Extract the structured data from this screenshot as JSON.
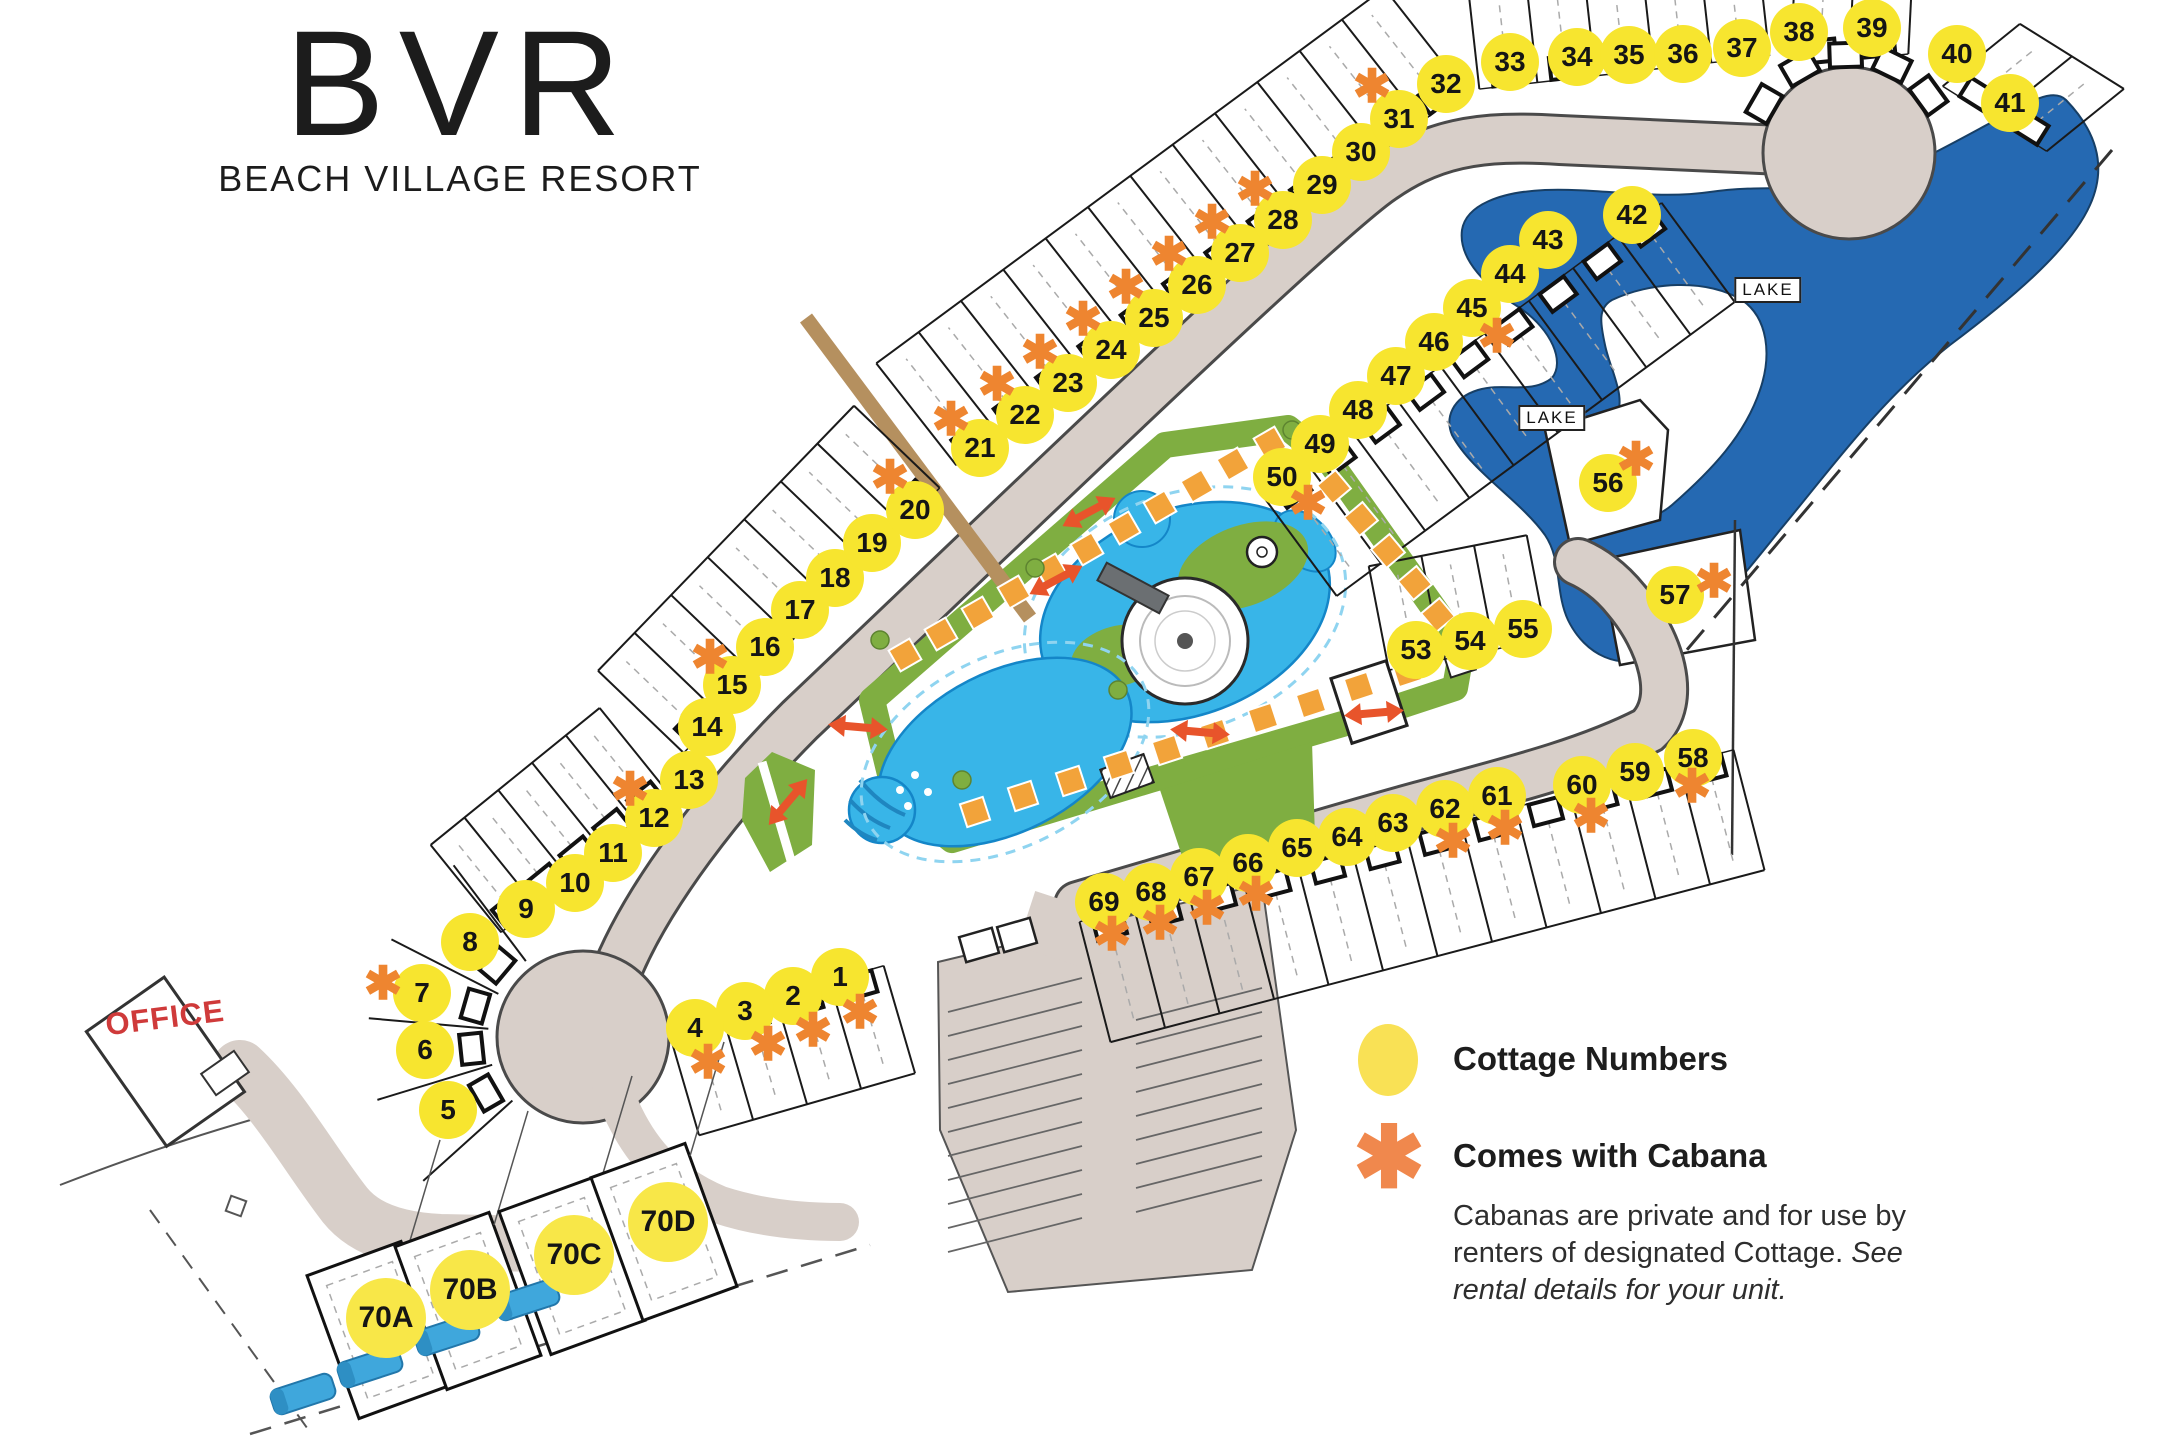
{
  "logo": {
    "abbr": "BVR",
    "name": "BEACH VILLAGE RESORT"
  },
  "office_label": "OFFICE",
  "lake_labels": [
    {
      "text": "LAKE",
      "x": 1768,
      "y": 290
    },
    {
      "text": "LAKE",
      "x": 1552,
      "y": 418
    }
  ],
  "legend": {
    "cottage_label": "Cottage Numbers",
    "cabana_label": "Comes with Cabana",
    "cabana_symbol": "✱",
    "note_normal": "Cabanas are private and for use by renters of designated Cottage. ",
    "note_italic": "See rental details for your unit."
  },
  "colors": {
    "circle_yellow": "#f7e52f",
    "asterisk_orange": "#ee8530",
    "road": "#d8cfc9",
    "lake": "#2569b2",
    "green": "#7fae41",
    "pool": "#38b5e8",
    "office_red": "#cf3a3a"
  },
  "map": {
    "cottages": [
      {
        "n": "1",
        "x": 840,
        "y": 977,
        "ax": 860,
        "ay": 1012
      },
      {
        "n": "2",
        "x": 793,
        "y": 996,
        "ax": 813,
        "ay": 1030
      },
      {
        "n": "3",
        "x": 745,
        "y": 1011,
        "ax": 768,
        "ay": 1044
      },
      {
        "n": "4",
        "x": 695,
        "y": 1028,
        "ax": 708,
        "ay": 1062
      },
      {
        "n": "5",
        "x": 448,
        "y": 1110
      },
      {
        "n": "6",
        "x": 425,
        "y": 1050
      },
      {
        "n": "7",
        "x": 422,
        "y": 993,
        "ax": 383,
        "ay": 983
      },
      {
        "n": "8",
        "x": 470,
        "y": 942
      },
      {
        "n": "9",
        "x": 526,
        "y": 909
      },
      {
        "n": "10",
        "x": 575,
        "y": 883
      },
      {
        "n": "11",
        "x": 613,
        "y": 853
      },
      {
        "n": "12",
        "x": 654,
        "y": 818,
        "ax": 630,
        "ay": 789
      },
      {
        "n": "13",
        "x": 689,
        "y": 780
      },
      {
        "n": "14",
        "x": 707,
        "y": 727
      },
      {
        "n": "15",
        "x": 732,
        "y": 685,
        "ax": 710,
        "ay": 657
      },
      {
        "n": "16",
        "x": 765,
        "y": 647
      },
      {
        "n": "17",
        "x": 800,
        "y": 610
      },
      {
        "n": "18",
        "x": 835,
        "y": 578
      },
      {
        "n": "19",
        "x": 872,
        "y": 543
      },
      {
        "n": "20",
        "x": 915,
        "y": 510,
        "ax": 890,
        "ay": 477
      },
      {
        "n": "21",
        "x": 980,
        "y": 448,
        "ax": 951,
        "ay": 419
      },
      {
        "n": "22",
        "x": 1025,
        "y": 415,
        "ax": 997,
        "ay": 384
      },
      {
        "n": "23",
        "x": 1068,
        "y": 383,
        "ax": 1040,
        "ay": 352
      },
      {
        "n": "24",
        "x": 1111,
        "y": 350,
        "ax": 1083,
        "ay": 319
      },
      {
        "n": "25",
        "x": 1154,
        "y": 318,
        "ax": 1126,
        "ay": 287
      },
      {
        "n": "26",
        "x": 1197,
        "y": 285,
        "ax": 1169,
        "ay": 254
      },
      {
        "n": "27",
        "x": 1240,
        "y": 253,
        "ax": 1212,
        "ay": 222
      },
      {
        "n": "28",
        "x": 1283,
        "y": 220,
        "ax": 1255,
        "ay": 189
      },
      {
        "n": "29",
        "x": 1322,
        "y": 185
      },
      {
        "n": "30",
        "x": 1361,
        "y": 152
      },
      {
        "n": "31",
        "x": 1399,
        "y": 119,
        "ax": 1372,
        "ay": 86
      },
      {
        "n": "32",
        "x": 1446,
        "y": 84
      },
      {
        "n": "33",
        "x": 1510,
        "y": 62
      },
      {
        "n": "34",
        "x": 1577,
        "y": 57
      },
      {
        "n": "35",
        "x": 1629,
        "y": 55
      },
      {
        "n": "36",
        "x": 1683,
        "y": 54
      },
      {
        "n": "37",
        "x": 1742,
        "y": 48
      },
      {
        "n": "38",
        "x": 1799,
        "y": 32
      },
      {
        "n": "39",
        "x": 1872,
        "y": 28
      },
      {
        "n": "40",
        "x": 1957,
        "y": 54
      },
      {
        "n": "41",
        "x": 2010,
        "y": 103
      },
      {
        "n": "42",
        "x": 1632,
        "y": 215
      },
      {
        "n": "43",
        "x": 1548,
        "y": 240
      },
      {
        "n": "44",
        "x": 1510,
        "y": 274
      },
      {
        "n": "45",
        "x": 1472,
        "y": 308,
        "ax": 1497,
        "ay": 336
      },
      {
        "n": "46",
        "x": 1434,
        "y": 342
      },
      {
        "n": "47",
        "x": 1396,
        "y": 376
      },
      {
        "n": "48",
        "x": 1358,
        "y": 410
      },
      {
        "n": "49",
        "x": 1320,
        "y": 444
      },
      {
        "n": "50",
        "x": 1282,
        "y": 477,
        "ax": 1308,
        "ay": 503
      },
      {
        "n": "53",
        "x": 1416,
        "y": 650
      },
      {
        "n": "54",
        "x": 1470,
        "y": 641
      },
      {
        "n": "55",
        "x": 1523,
        "y": 629
      },
      {
        "n": "56",
        "x": 1608,
        "y": 483,
        "ax": 1636,
        "ay": 459
      },
      {
        "n": "57",
        "x": 1675,
        "y": 595,
        "ax": 1714,
        "ay": 581
      },
      {
        "n": "58",
        "x": 1693,
        "y": 758,
        "ax": 1692,
        "ay": 786
      },
      {
        "n": "59",
        "x": 1635,
        "y": 772
      },
      {
        "n": "60",
        "x": 1582,
        "y": 785,
        "ax": 1591,
        "ay": 816
      },
      {
        "n": "61",
        "x": 1497,
        "y": 796,
        "ax": 1505,
        "ay": 828
      },
      {
        "n": "62",
        "x": 1445,
        "y": 809,
        "ax": 1453,
        "ay": 841
      },
      {
        "n": "63",
        "x": 1393,
        "y": 823
      },
      {
        "n": "64",
        "x": 1347,
        "y": 837
      },
      {
        "n": "65",
        "x": 1297,
        "y": 848
      },
      {
        "n": "66",
        "x": 1248,
        "y": 863,
        "ax": 1256,
        "ay": 894
      },
      {
        "n": "67",
        "x": 1199,
        "y": 877,
        "ax": 1207,
        "ay": 908
      },
      {
        "n": "68",
        "x": 1151,
        "y": 892,
        "ax": 1160,
        "ay": 923
      },
      {
        "n": "69",
        "x": 1104,
        "y": 902,
        "ax": 1112,
        "ay": 934
      },
      {
        "n": "70A",
        "x": 386,
        "y": 1318,
        "big": true
      },
      {
        "n": "70B",
        "x": 470,
        "y": 1290,
        "big": true
      },
      {
        "n": "70C",
        "x": 574,
        "y": 1255,
        "big": true
      },
      {
        "n": "70D",
        "x": 668,
        "y": 1222,
        "big": true
      }
    ],
    "lot_rows": [
      {
        "x1": 960,
        "y1": 470,
        "x2": 1468,
        "y2": 95,
        "c": 12,
        "nx": -0.62,
        "ny": -0.79,
        "d": 135
      },
      {
        "x1": 1480,
        "y1": 95,
        "x2": 1770,
        "y2": 62,
        "c": 5,
        "nx": -0.11,
        "ny": -0.99,
        "d": 118
      },
      {
        "x1": 1790,
        "y1": 72,
        "x2": 1908,
        "y2": 60,
        "c": 2,
        "nx": 0.05,
        "ny": -1.0,
        "d": 105
      },
      {
        "x1": 1938,
        "y1": 90,
        "x2": 2042,
        "y2": 155,
        "c": 2,
        "nx": 0.78,
        "ny": -0.63,
        "d": 105
      },
      {
        "x1": 1658,
        "y1": 198,
        "x2": 1260,
        "y2": 492,
        "c": 9,
        "nx": 0.59,
        "ny": 0.8,
        "d": 130
      },
      {
        "x1": 1390,
        "y1": 676,
        "x2": 1548,
        "y2": 645,
        "c": 3,
        "nx": -0.19,
        "ny": -0.98,
        "d": 112
      },
      {
        "x1": 1732,
        "y1": 744,
        "x2": 1078,
        "y2": 916,
        "c": 12,
        "nx": 0.25,
        "ny": 0.97,
        "d": 130
      },
      {
        "x1": 882,
        "y1": 960,
        "x2": 666,
        "y2": 1022,
        "c": 4,
        "nx": 0.28,
        "ny": 0.96,
        "d": 118
      },
      {
        "x1": 688,
        "y1": 757,
        "x2": 944,
        "y2": 492,
        "c": 7,
        "nx": -0.72,
        "ny": -0.69,
        "d": 125
      },
      {
        "x1": 505,
        "y1": 937,
        "x2": 674,
        "y2": 800,
        "c": 5,
        "nx": -0.63,
        "ny": -0.78,
        "d": 118
      }
    ],
    "fan": {
      "cx": 583,
      "cy": 1037,
      "r0": 95,
      "r1": 215,
      "angles": [
        138,
        163,
        185,
        207,
        233
      ],
      "fp_angles": [
        150,
        174,
        196,
        220
      ],
      "fp_r": 112
    },
    "culdesac_fp": {
      "cx": 1849,
      "cy": 153,
      "r": 98,
      "angles": [
        210,
        240,
        268,
        296,
        324
      ]
    },
    "big_lots": [
      [
        380,
        1330
      ],
      [
        468,
        1301
      ],
      [
        572,
        1266
      ],
      [
        664,
        1232
      ]
    ],
    "big_lot_rot": -20,
    "rvs": [
      [
        303,
        1394,
        -18
      ],
      [
        370,
        1367,
        -18
      ],
      [
        447,
        1335,
        -18
      ],
      [
        527,
        1300,
        -18
      ]
    ],
    "cabana_squares": [
      [
        905,
        655,
        -30
      ],
      [
        941,
        634,
        -30
      ],
      [
        978,
        613,
        -30
      ],
      [
        1014,
        592,
        -30
      ],
      [
        1051,
        570,
        -30
      ],
      [
        1087,
        549,
        -30
      ],
      [
        1124,
        528,
        -30
      ],
      [
        1160,
        507,
        -30
      ],
      [
        1197,
        486,
        -30
      ],
      [
        1233,
        464,
        -30
      ],
      [
        1270,
        443,
        -30
      ],
      [
        975,
        812,
        -18
      ],
      [
        1023,
        796,
        -18
      ],
      [
        1071,
        781,
        -18
      ],
      [
        1119,
        765,
        -18
      ],
      [
        1167,
        750,
        -18
      ],
      [
        1215,
        734,
        -18
      ],
      [
        1263,
        718,
        -18
      ],
      [
        1311,
        703,
        -18
      ],
      [
        1359,
        687,
        -18
      ],
      [
        1407,
        672,
        -18
      ],
      [
        1307,
        455,
        50
      ],
      [
        1334,
        487,
        50
      ],
      [
        1361,
        519,
        50
      ],
      [
        1388,
        551,
        50
      ],
      [
        1415,
        583,
        50
      ],
      [
        1438,
        615,
        50
      ]
    ],
    "arrows": [
      [
        1089,
        512,
        62
      ],
      [
        1056,
        580,
        62
      ],
      [
        858,
        727,
        95
      ],
      [
        788,
        802,
        40
      ],
      [
        1200,
        732,
        95
      ],
      [
        1374,
        713,
        85
      ]
    ],
    "trees": [
      [
        1035,
        568
      ],
      [
        1118,
        690
      ],
      [
        1292,
        430
      ],
      [
        1450,
        640
      ],
      [
        962,
        780
      ],
      [
        880,
        640
      ]
    ]
  }
}
